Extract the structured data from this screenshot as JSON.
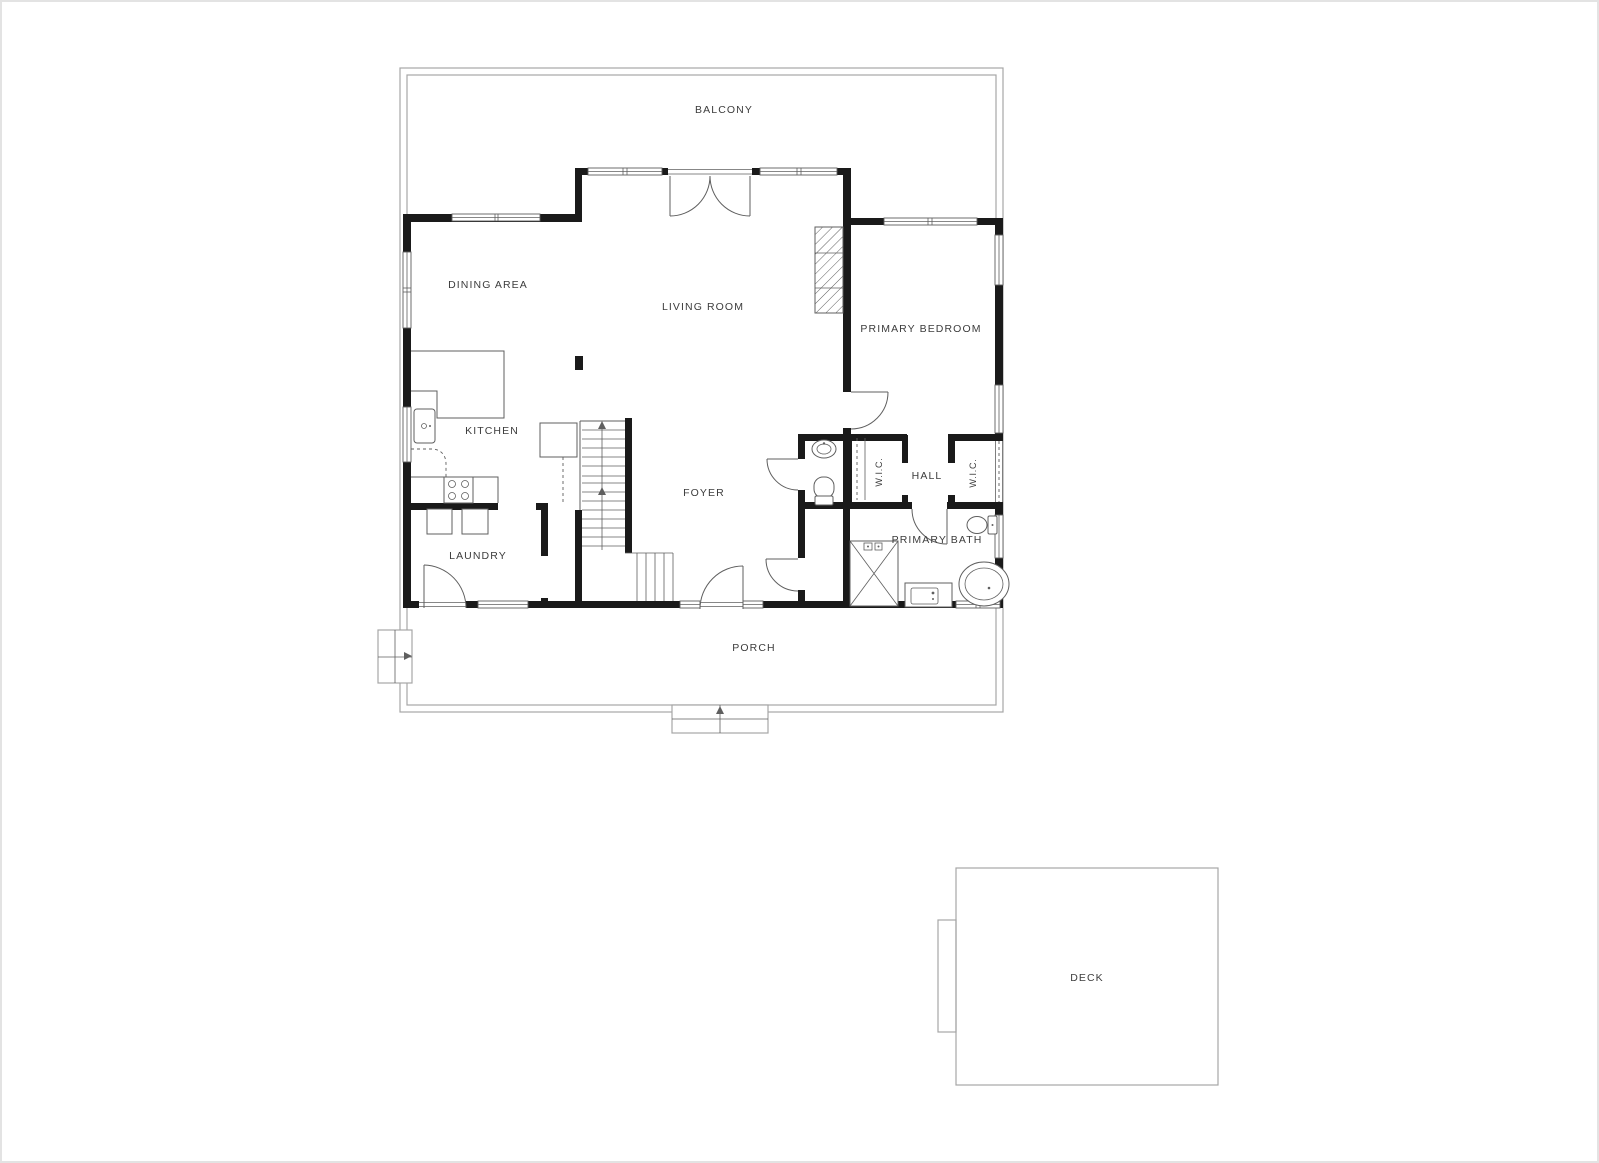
{
  "floorplan": {
    "title": "First floor plan",
    "rooms": [
      {
        "id": "balcony",
        "label": "BALCONY"
      },
      {
        "id": "dining-area",
        "label": "DINING AREA"
      },
      {
        "id": "living-room",
        "label": "LIVING ROOM"
      },
      {
        "id": "primary-bedroom",
        "label": "PRIMARY BEDROOM"
      },
      {
        "id": "kitchen",
        "label": "KITCHEN"
      },
      {
        "id": "wic-left",
        "label": "W.I.C."
      },
      {
        "id": "hall",
        "label": "HALL"
      },
      {
        "id": "wic-right",
        "label": "W.I.C."
      },
      {
        "id": "foyer",
        "label": "FOYER"
      },
      {
        "id": "laundry",
        "label": "LAUNDRY"
      },
      {
        "id": "primary-bath",
        "label": "PRIMARY BATH"
      },
      {
        "id": "porch",
        "label": "PORCH"
      },
      {
        "id": "deck",
        "label": "DECK"
      }
    ],
    "colors": {
      "background": "#ffffff",
      "wall": "#1a1a1a",
      "line": "#5f5f5f",
      "boundary": "#a6a6a6",
      "label": "#3c3c3c"
    }
  }
}
